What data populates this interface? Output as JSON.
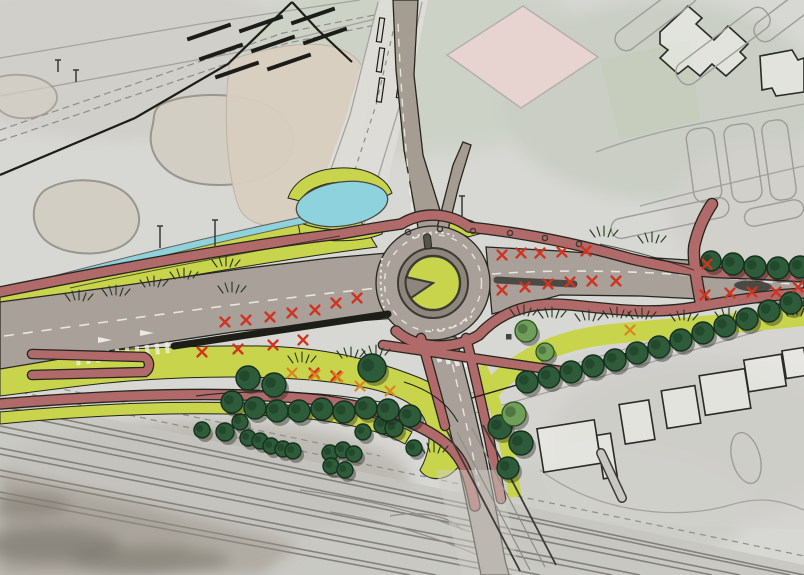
{
  "meta": {
    "title": "Roundabout reconstruction landscape site plan",
    "type": "traffic-landscape-design-plan",
    "base_layer": "faded aerial photograph",
    "micro_labels": "illegible street name micro-text on base map"
  },
  "palette": {
    "aerial_base": "#d7d7d3",
    "road_gray": "#a8a099",
    "road_new": "#a59c92",
    "apron_gray": "#8d867c",
    "outline_dark": "#26261f",
    "verge_lime": "#c9d44d",
    "cycle_path_pink": "#b06a6a",
    "water_blue": "#8ed2de",
    "tree_dark": "#2e5c3a",
    "tree_light": "#6f9e58",
    "tree_outline": "#15301d",
    "mark_red": "#d03421",
    "mark_orange": "#d8871f",
    "rail_line": "#83817b",
    "building_outline": "#2a2a26",
    "field_pink": "#e7d4d0",
    "white_marking": "#f2f1ea"
  },
  "legend": {
    "verge_lime": "new grass verge",
    "cycle_path_pink": "cycle path",
    "road_gray": "carriageway",
    "water_blue": "watercourse / pond",
    "tree_dark": "existing/new tree",
    "mark_red": "removal mark on carriageway",
    "mark_orange": "removal mark on verge",
    "rail_line": "railway corridor",
    "field_pink": "sports field"
  },
  "map": {
    "trees_dark": [
      [
        248,
        378,
        12
      ],
      [
        274,
        385,
        12
      ],
      [
        372,
        368,
        14
      ],
      [
        232,
        402,
        11
      ],
      [
        255,
        408,
        11
      ],
      [
        277,
        411,
        11
      ],
      [
        299,
        411,
        11
      ],
      [
        322,
        409,
        11
      ],
      [
        344,
        412,
        11
      ],
      [
        366,
        408,
        11
      ],
      [
        388,
        410,
        11
      ],
      [
        410,
        416,
        11
      ],
      [
        500,
        427,
        12
      ],
      [
        521,
        443,
        12
      ],
      [
        508,
        468,
        11
      ],
      [
        527,
        382,
        11
      ],
      [
        549,
        377,
        11
      ],
      [
        571,
        372,
        11
      ],
      [
        593,
        366,
        11
      ],
      [
        615,
        360,
        11
      ],
      [
        637,
        353,
        11
      ],
      [
        659,
        347,
        11
      ],
      [
        681,
        340,
        11
      ],
      [
        703,
        333,
        11
      ],
      [
        725,
        326,
        11
      ],
      [
        747,
        319,
        11
      ],
      [
        769,
        311,
        11
      ],
      [
        791,
        303,
        11
      ],
      [
        711,
        261,
        10
      ],
      [
        733,
        264,
        11
      ],
      [
        755,
        267,
        11
      ],
      [
        778,
        268,
        11
      ],
      [
        800,
        267,
        11
      ]
    ],
    "trees_small": [
      [
        202,
        430,
        8
      ],
      [
        225,
        432,
        9
      ],
      [
        240,
        422,
        8
      ],
      [
        248,
        438,
        8
      ],
      [
        260,
        441,
        8
      ],
      [
        271,
        446,
        8
      ],
      [
        283,
        449,
        8
      ],
      [
        293,
        451,
        8
      ],
      [
        330,
        453,
        8
      ],
      [
        343,
        450,
        8
      ],
      [
        354,
        454,
        8
      ],
      [
        383,
        425,
        9
      ],
      [
        394,
        428,
        9
      ],
      [
        363,
        432,
        8
      ],
      [
        331,
        466,
        8
      ],
      [
        345,
        470,
        8
      ],
      [
        414,
        448,
        8
      ]
    ],
    "trees_light": [
      [
        526,
        331,
        11
      ],
      [
        514,
        414,
        12
      ],
      [
        545,
        352,
        9
      ]
    ],
    "x_marks_red": [
      [
        225,
        322
      ],
      [
        246,
        320
      ],
      [
        270,
        317
      ],
      [
        292,
        313
      ],
      [
        315,
        310
      ],
      [
        336,
        303
      ],
      [
        357,
        298
      ],
      [
        202,
        352
      ],
      [
        238,
        349
      ],
      [
        273,
        345
      ],
      [
        303,
        340
      ],
      [
        314,
        373
      ],
      [
        336,
        376
      ],
      [
        502,
        255
      ],
      [
        521,
        253
      ],
      [
        540,
        253
      ],
      [
        562,
        252
      ],
      [
        586,
        251
      ],
      [
        502,
        290
      ],
      [
        525,
        287
      ],
      [
        548,
        284
      ],
      [
        570,
        282
      ],
      [
        592,
        281
      ],
      [
        616,
        281
      ],
      [
        707,
        264
      ],
      [
        705,
        295
      ],
      [
        730,
        293
      ],
      [
        752,
        292
      ],
      [
        776,
        292
      ],
      [
        798,
        287
      ]
    ],
    "x_marks_orange": [
      [
        292,
        373
      ],
      [
        315,
        375
      ],
      [
        338,
        377
      ],
      [
        360,
        386
      ],
      [
        390,
        391
      ],
      [
        630,
        330
      ]
    ],
    "lamp_circles": [
      [
        408,
        232
      ],
      [
        440,
        229
      ],
      [
        473,
        231
      ],
      [
        510,
        233
      ],
      [
        545,
        238
      ],
      [
        579,
        244
      ]
    ],
    "grass_tufts": [
      [
        75,
        300
      ],
      [
        112,
        295
      ],
      [
        150,
        286
      ],
      [
        180,
        278
      ],
      [
        222,
        266
      ],
      [
        228,
        292
      ],
      [
        298,
        362
      ],
      [
        347,
        357
      ],
      [
        372,
        355
      ],
      [
        430,
        452
      ],
      [
        520,
        315
      ],
      [
        548,
        317
      ],
      [
        585,
        320
      ],
      [
        613,
        317
      ],
      [
        638,
        318
      ],
      [
        680,
        320
      ],
      [
        725,
        318
      ],
      [
        793,
        315
      ],
      [
        648,
        242
      ],
      [
        600,
        236
      ]
    ],
    "pole_ticks": [
      [
        160,
        226,
        22
      ],
      [
        215,
        220,
        26
      ],
      [
        462,
        196,
        20
      ],
      [
        58,
        60,
        12
      ],
      [
        76,
        70,
        12
      ]
    ],
    "houses": [
      [
        540,
        424,
        58,
        44,
        -9
      ],
      [
        600,
        434,
        14,
        44,
        -9
      ],
      [
        622,
        402,
        30,
        40,
        -9
      ],
      [
        664,
        388,
        34,
        38,
        -9
      ],
      [
        702,
        372,
        46,
        40,
        -9
      ],
      [
        746,
        357,
        38,
        32,
        -9
      ],
      [
        784,
        349,
        22,
        28,
        -9
      ]
    ],
    "parking_outlines": [
      [
        608,
        6,
        96,
        22,
        -37
      ],
      [
        668,
        34,
        110,
        24,
        -37
      ],
      [
        748,
        0,
        86,
        22,
        -37
      ],
      [
        690,
        128,
        28,
        74,
        -8
      ],
      [
        728,
        124,
        30,
        78,
        -8
      ],
      [
        766,
        120,
        26,
        80,
        -8
      ],
      [
        610,
        208,
        120,
        20,
        -12
      ],
      [
        744,
        204,
        60,
        18,
        -12
      ]
    ],
    "platform_bars": [
      [
        186,
        30
      ],
      [
        238,
        22
      ],
      [
        290,
        14
      ],
      [
        198,
        50
      ],
      [
        250,
        42
      ],
      [
        302,
        34
      ],
      [
        214,
        68
      ],
      [
        266,
        60
      ]
    ],
    "north_road_bars": [
      [
        378,
        18
      ],
      [
        378,
        48
      ],
      [
        378,
        78
      ],
      [
        398,
        14
      ],
      [
        398,
        44
      ],
      [
        398,
        74
      ]
    ]
  }
}
